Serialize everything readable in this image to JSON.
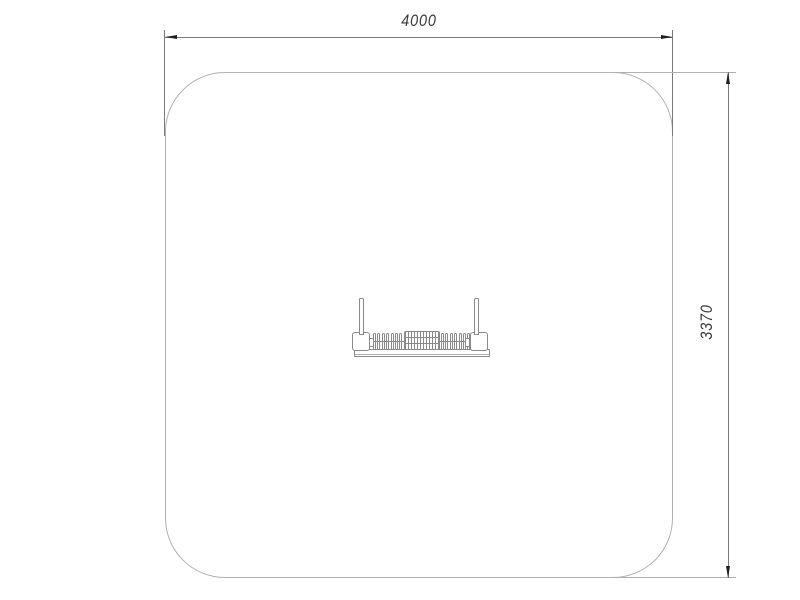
{
  "drawing": {
    "dimensions": {
      "width_label": "4000",
      "height_label": "3370"
    },
    "colors": {
      "background": "#ffffff",
      "outline": "#b0b0b0",
      "dimension_line": "#7a7a7a",
      "arrow": "#1f1f1f",
      "equipment_stroke": "#8a8a8a",
      "text": "#3a3a3a"
    },
    "equipment": {
      "coil_count_per_side": 7
    }
  }
}
